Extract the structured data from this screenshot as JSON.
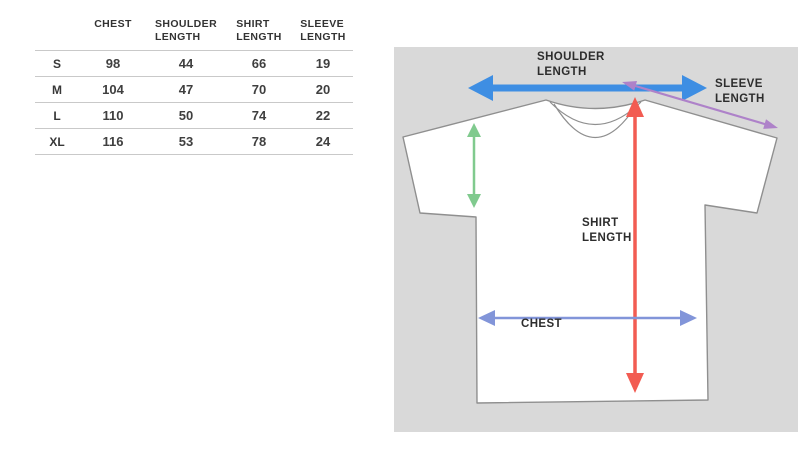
{
  "size_chart": {
    "headers": {
      "size": "",
      "chest": "CHEST",
      "shoulder_length": "SHOULDER\nLENGTH",
      "shirt_length": "SHIRT\nLENGTH",
      "sleeve_length": "SLEEVE\nLENGTH"
    },
    "rows": [
      {
        "size": "S",
        "chest": "98",
        "shoulder_length": "44",
        "shirt_length": "66",
        "sleeve_length": "19"
      },
      {
        "size": "M",
        "chest": "104",
        "shoulder_length": "47",
        "shirt_length": "70",
        "sleeve_length": "20"
      },
      {
        "size": "L",
        "chest": "110",
        "shoulder_length": "50",
        "shirt_length": "74",
        "sleeve_length": "22"
      },
      {
        "size": "XL",
        "chest": "116",
        "shoulder_length": "53",
        "shirt_length": "78",
        "sleeve_length": "24"
      }
    ]
  },
  "diagram": {
    "labels": {
      "shoulder_length": "SHOULDER\nLENGTH",
      "sleeve_length": "SLEEVE\nLENGTH",
      "shirt_length": "SHIRT\nLENGTH",
      "chest": "CHEST"
    },
    "colors": {
      "panel_bg": "#d9d9d9",
      "shirt_outline": "#8f8f8f",
      "shoulder_arrow": "#3e8ee3",
      "sleeve_arrow": "#ae82c9",
      "armhole_arrow": "#80ca8e",
      "shirt_length_arrow": "#f25c52",
      "chest_arrow": "#8295d9"
    }
  }
}
